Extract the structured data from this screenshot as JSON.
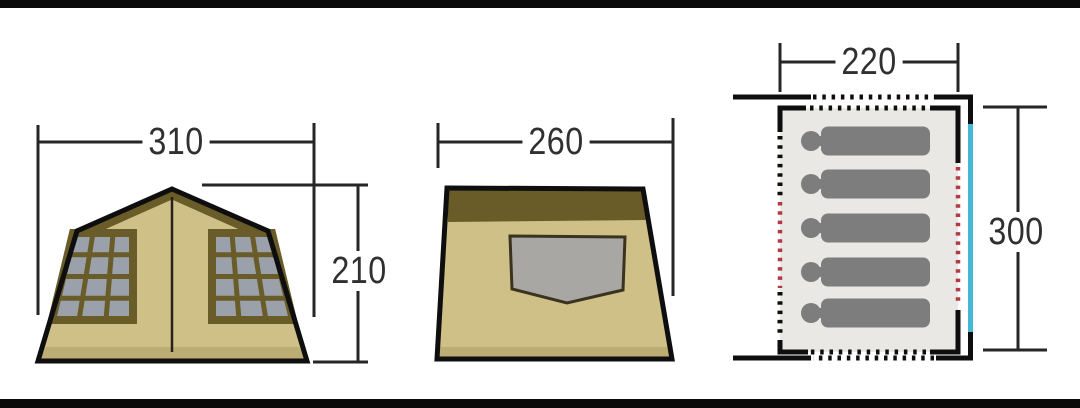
{
  "figures": {
    "front_view": {
      "title": "tent front elevation",
      "width_label": "310",
      "height_label": "210",
      "window_panes_per_window": 12
    },
    "side_view": {
      "title": "tent side elevation",
      "depth_label": "260"
    },
    "floor_plan": {
      "title": "tent floor plan",
      "width_label": "220",
      "length_label": "300",
      "sleeper_count": 5
    }
  },
  "colors": {
    "canvas-bg": "#ffffff",
    "letterbox": "#0a0a0a",
    "line": "#262626",
    "outline": "#0e0e0e",
    "tent-tan": "#cec087",
    "tent-olive": "#6a5c28",
    "tent-base": "#bdac74",
    "pane-gray": "#9ba1ab",
    "side-window-gray": "#a9a7a4",
    "plan-interior": "#eae8e4",
    "sleeper-gray": "#7d7d7d",
    "door-cyan": "#44b7d7",
    "dot-red": "#b23a44",
    "label-ink": "#303030"
  }
}
